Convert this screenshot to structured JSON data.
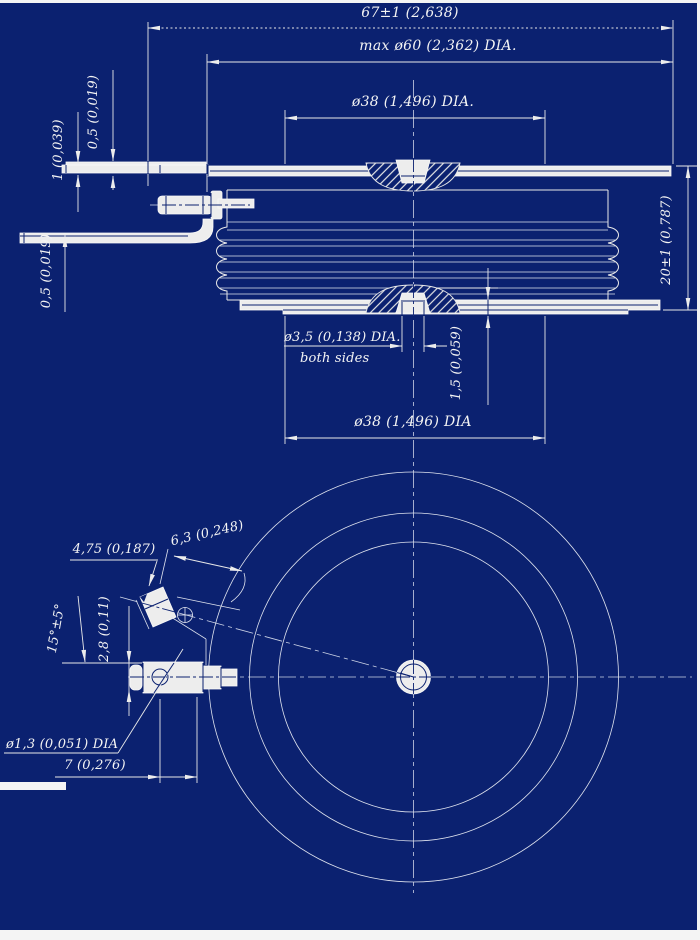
{
  "colors": {
    "background": "#0b2170",
    "line": "#e9e9e9",
    "fill_white": "#ededed",
    "text": "#f4f4f4",
    "margin": "#f4f4f4"
  },
  "side_view": {
    "dim_overall_width": "67±1 (2,638)",
    "dim_max_diameter": "max ø60 (2,362) DIA.",
    "dim_pole_diameter_top": "ø38 (1,496) DIA.",
    "dim_sheet_thickness": "0,5 (0,019)",
    "dim_lead_thickness": "1 (0,039)",
    "dim_strip_thickness": "0,5 (0,019)",
    "dim_height": "20±1 (0,787)",
    "dim_gate_hole": "ø3,5 (0,138) DIA.",
    "note_gate_hole": "both sides",
    "dim_boss_height": "1,5 (0,059)",
    "dim_pole_diameter_bottom": "ø38 (1,496) DIA"
  },
  "bottom_view": {
    "dim_lug_width": "4,75 (0,187)",
    "dim_lug_length": "6,3 (0,248)",
    "dim_lead_angle": "15°±5°",
    "dim_lead_offset": "2,8 (0,11)",
    "dim_hole_diameter": "ø1,3 (0,051) DIA",
    "dim_tip_distance": "7 (0,276)"
  }
}
